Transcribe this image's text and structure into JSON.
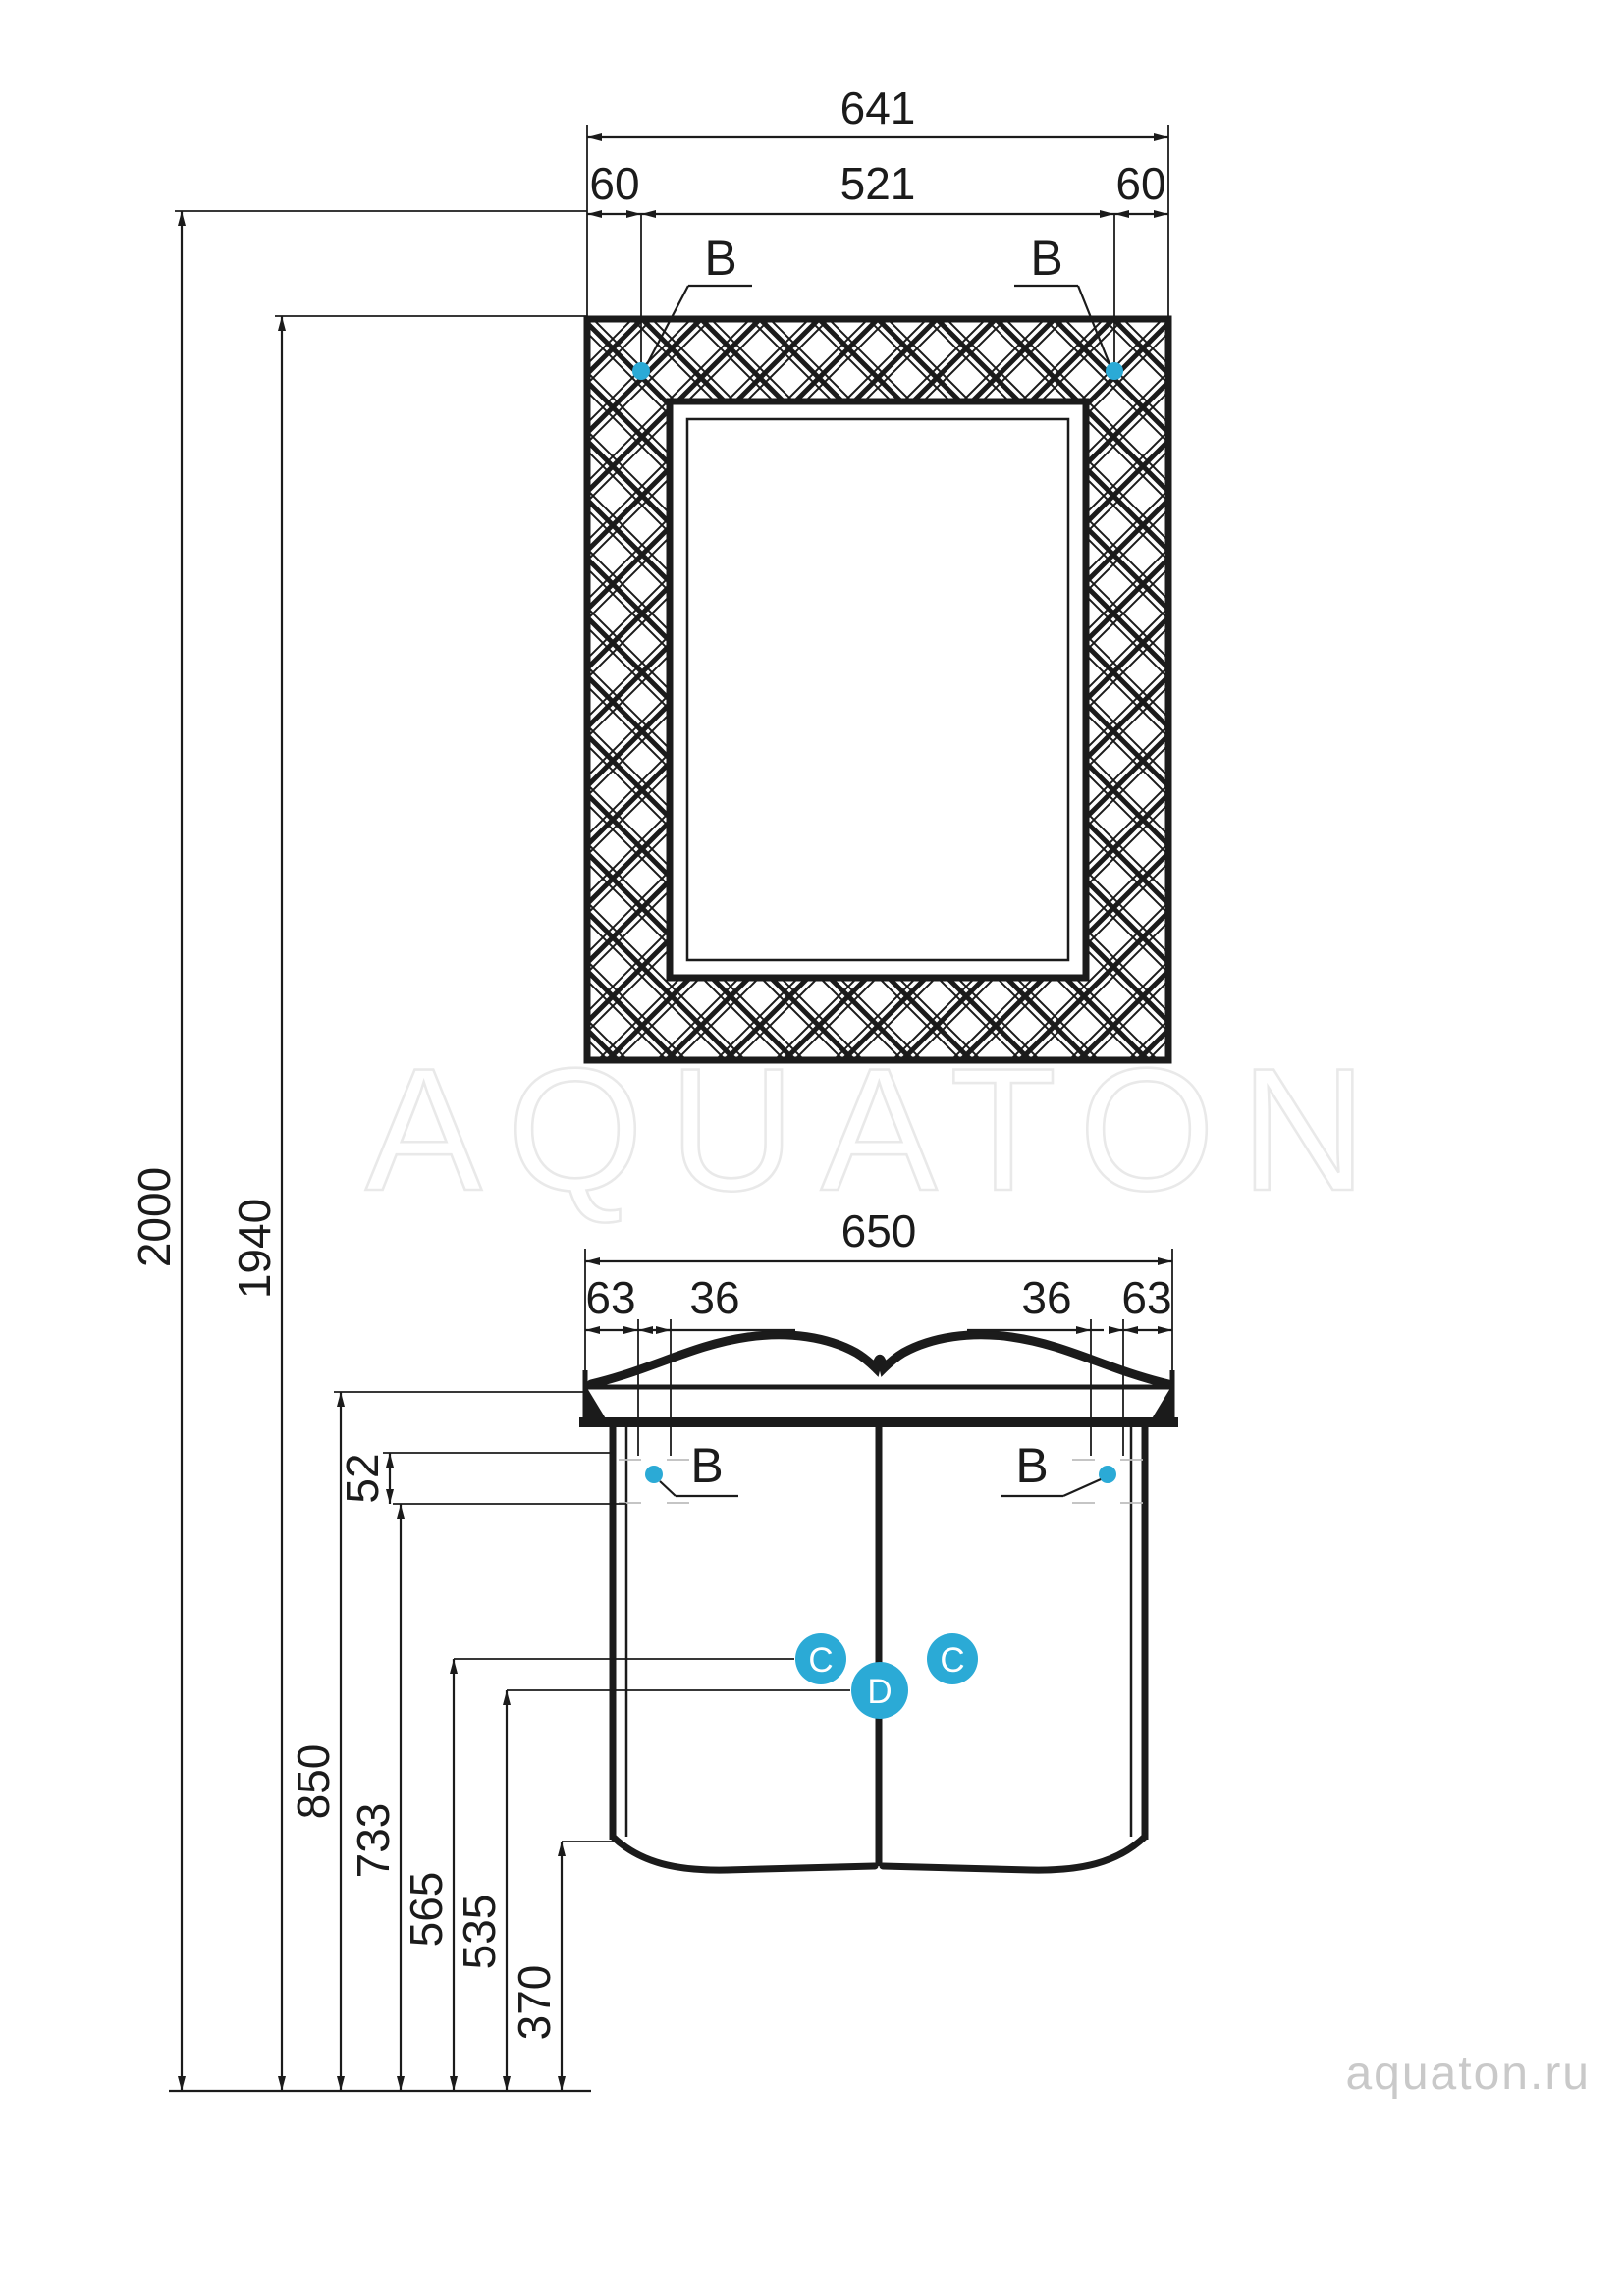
{
  "drawing": {
    "brand_watermark": "AQUATON",
    "site_watermark": "aquaton.ru",
    "mirror": {
      "overall_width": "641",
      "left_offset": "60",
      "mount_spacing": "521",
      "right_offset": "60",
      "mount_label_left": "B",
      "mount_label_right": "B"
    },
    "heights": {
      "overall": "2000",
      "mirror_top": "1940"
    },
    "cabinet": {
      "overall_width": "650",
      "side_offset_left": "63",
      "mount_inset_left": "36",
      "mount_inset_right": "36",
      "side_offset_right": "63",
      "mount_label_left": "B",
      "mount_label_right": "B",
      "apron_height": "52",
      "worktop_height": "850",
      "apron_bottom_height": "733",
      "hinge_upper_height": "565",
      "hinge_lower_height": "535",
      "bottom_clearance": "370",
      "hinge_label_left": "C",
      "hinge_label_right": "C",
      "connector_label": "D"
    }
  },
  "colors": {
    "accent": "#2BAAD6",
    "ink": "#1B1B1B",
    "watermark_outline": "#E9E9E9",
    "watermark_text": "#C9C9C9"
  }
}
